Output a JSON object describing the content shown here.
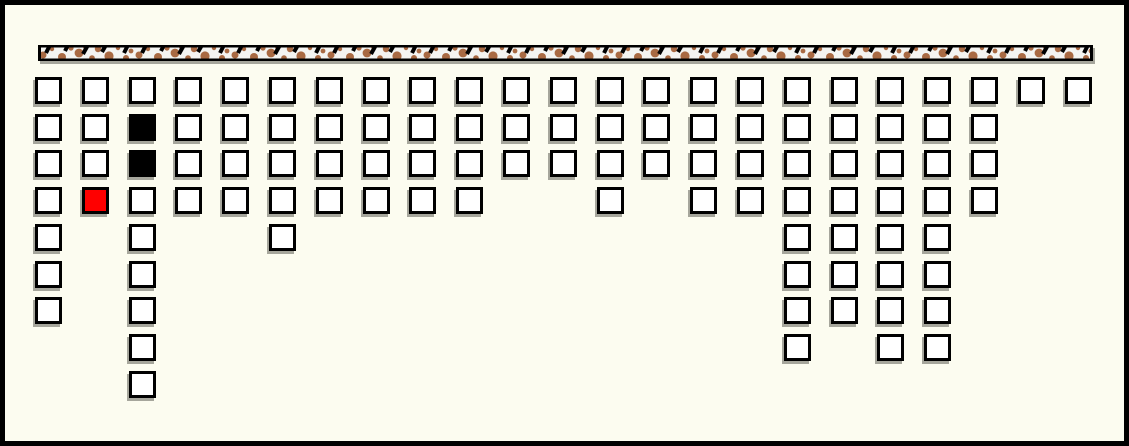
{
  "scene": {
    "background_color": "#FCFCF0",
    "frame_color": "#000000",
    "shadow_color": "#A6A69C",
    "palette": {
      "w": "#FFFFFF",
      "b": "#000000",
      "r": "#FF0000"
    },
    "bar": {
      "x": 38,
      "y": 45,
      "width": 1055,
      "height": 16,
      "fill": "#F4F4F1",
      "border_color": "#000000",
      "blob_color": "#A96A43",
      "dash_color": "#000000"
    },
    "grid": {
      "origin_x": 35,
      "origin_y": 77,
      "col_pitch": 46.8,
      "row_pitch": 36.7,
      "cell_size": 27,
      "columns": 23,
      "rows": 9,
      "cell_counts_by_row": [
        23,
        21,
        21,
        18,
        7,
        6,
        6,
        4,
        1
      ],
      "black_cells": [
        [
          1,
          2
        ],
        [
          2,
          2
        ]
      ],
      "red_cells": [
        [
          3,
          1
        ]
      ],
      "cells": [
        [
          0,
          0,
          "w"
        ],
        [
          0,
          1,
          "w"
        ],
        [
          0,
          2,
          "w"
        ],
        [
          0,
          3,
          "w"
        ],
        [
          0,
          4,
          "w"
        ],
        [
          0,
          5,
          "w"
        ],
        [
          0,
          6,
          "w"
        ],
        [
          0,
          7,
          "w"
        ],
        [
          0,
          8,
          "w"
        ],
        [
          0,
          9,
          "w"
        ],
        [
          0,
          10,
          "w"
        ],
        [
          0,
          11,
          "w"
        ],
        [
          0,
          12,
          "w"
        ],
        [
          0,
          13,
          "w"
        ],
        [
          0,
          14,
          "w"
        ],
        [
          0,
          15,
          "w"
        ],
        [
          0,
          16,
          "w"
        ],
        [
          0,
          17,
          "w"
        ],
        [
          0,
          18,
          "w"
        ],
        [
          0,
          19,
          "w"
        ],
        [
          0,
          20,
          "w"
        ],
        [
          0,
          21,
          "w"
        ],
        [
          0,
          22,
          "w"
        ],
        [
          1,
          0,
          "w"
        ],
        [
          1,
          1,
          "w"
        ],
        [
          1,
          2,
          "b"
        ],
        [
          1,
          3,
          "w"
        ],
        [
          1,
          4,
          "w"
        ],
        [
          1,
          5,
          "w"
        ],
        [
          1,
          6,
          "w"
        ],
        [
          1,
          7,
          "w"
        ],
        [
          1,
          8,
          "w"
        ],
        [
          1,
          9,
          "w"
        ],
        [
          1,
          10,
          "w"
        ],
        [
          1,
          11,
          "w"
        ],
        [
          1,
          12,
          "w"
        ],
        [
          1,
          13,
          "w"
        ],
        [
          1,
          14,
          "w"
        ],
        [
          1,
          15,
          "w"
        ],
        [
          1,
          16,
          "w"
        ],
        [
          1,
          17,
          "w"
        ],
        [
          1,
          18,
          "w"
        ],
        [
          1,
          19,
          "w"
        ],
        [
          1,
          20,
          "w"
        ],
        [
          2,
          0,
          "w"
        ],
        [
          2,
          1,
          "w"
        ],
        [
          2,
          2,
          "b"
        ],
        [
          2,
          3,
          "w"
        ],
        [
          2,
          4,
          "w"
        ],
        [
          2,
          5,
          "w"
        ],
        [
          2,
          6,
          "w"
        ],
        [
          2,
          7,
          "w"
        ],
        [
          2,
          8,
          "w"
        ],
        [
          2,
          9,
          "w"
        ],
        [
          2,
          10,
          "w"
        ],
        [
          2,
          11,
          "w"
        ],
        [
          2,
          12,
          "w"
        ],
        [
          2,
          13,
          "w"
        ],
        [
          2,
          14,
          "w"
        ],
        [
          2,
          15,
          "w"
        ],
        [
          2,
          16,
          "w"
        ],
        [
          2,
          17,
          "w"
        ],
        [
          2,
          18,
          "w"
        ],
        [
          2,
          19,
          "w"
        ],
        [
          2,
          20,
          "w"
        ],
        [
          3,
          0,
          "w"
        ],
        [
          3,
          1,
          "r"
        ],
        [
          3,
          2,
          "w"
        ],
        [
          3,
          3,
          "w"
        ],
        [
          3,
          4,
          "w"
        ],
        [
          3,
          5,
          "w"
        ],
        [
          3,
          6,
          "w"
        ],
        [
          3,
          7,
          "w"
        ],
        [
          3,
          8,
          "w"
        ],
        [
          3,
          9,
          "w"
        ],
        [
          3,
          12,
          "w"
        ],
        [
          3,
          14,
          "w"
        ],
        [
          3,
          15,
          "w"
        ],
        [
          3,
          16,
          "w"
        ],
        [
          3,
          17,
          "w"
        ],
        [
          3,
          18,
          "w"
        ],
        [
          3,
          19,
          "w"
        ],
        [
          3,
          20,
          "w"
        ],
        [
          4,
          0,
          "w"
        ],
        [
          4,
          2,
          "w"
        ],
        [
          4,
          5,
          "w"
        ],
        [
          4,
          16,
          "w"
        ],
        [
          4,
          17,
          "w"
        ],
        [
          4,
          18,
          "w"
        ],
        [
          4,
          19,
          "w"
        ],
        [
          5,
          0,
          "w"
        ],
        [
          5,
          2,
          "w"
        ],
        [
          5,
          16,
          "w"
        ],
        [
          5,
          17,
          "w"
        ],
        [
          5,
          18,
          "w"
        ],
        [
          5,
          19,
          "w"
        ],
        [
          6,
          0,
          "w"
        ],
        [
          6,
          2,
          "w"
        ],
        [
          6,
          16,
          "w"
        ],
        [
          6,
          17,
          "w"
        ],
        [
          6,
          18,
          "w"
        ],
        [
          6,
          19,
          "w"
        ],
        [
          7,
          2,
          "w"
        ],
        [
          7,
          16,
          "w"
        ],
        [
          7,
          18,
          "w"
        ],
        [
          7,
          19,
          "w"
        ],
        [
          8,
          2,
          "w"
        ]
      ]
    }
  }
}
